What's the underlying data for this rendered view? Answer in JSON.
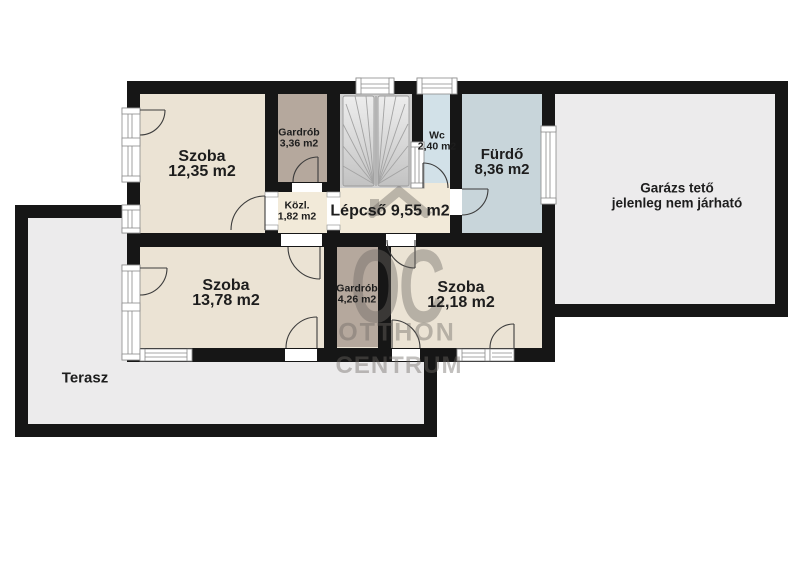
{
  "colors": {
    "wall": "#161616",
    "room": "#ebe3d4",
    "hall": "#f2ead9",
    "wardrobe": "#b5a89d",
    "wc": "#d2e1e8",
    "bath": "#c8d5da",
    "outdoor": "#ecebec",
    "label": "#1d1d1d",
    "door": "#3c3c3c",
    "frame": "#8a8a8a",
    "watermark": "rgba(110,106,100,0.42)"
  },
  "rooms": {
    "szoba1": {
      "name": "Szoba",
      "area": "12,35 m2"
    },
    "gardrob1": {
      "name": "Gardrób",
      "area": "3,36 m2"
    },
    "kozl": {
      "name": "Közl.",
      "area": "1,82 m2"
    },
    "lepcso": {
      "name": "Lépcső",
      "area": "9,55 m2"
    },
    "wc": {
      "name": "Wc",
      "area": "2,40 m2"
    },
    "furdo": {
      "name": "Fürdő",
      "area": "8,36 m2"
    },
    "garazs": {
      "name": "Garázs tető",
      "note": "jelenleg nem járható"
    },
    "szoba2": {
      "name": "Szoba",
      "area": "13,78 m2"
    },
    "gardrob2": {
      "name": "Gardrób",
      "area": "4,26 m2"
    },
    "szoba3": {
      "name": "Szoba",
      "area": "12,18 m2"
    },
    "terasz": {
      "name": "Terasz"
    }
  },
  "watermark": {
    "monogram": "OC",
    "line1": "OTTHON",
    "line2": "CENTRUM"
  }
}
